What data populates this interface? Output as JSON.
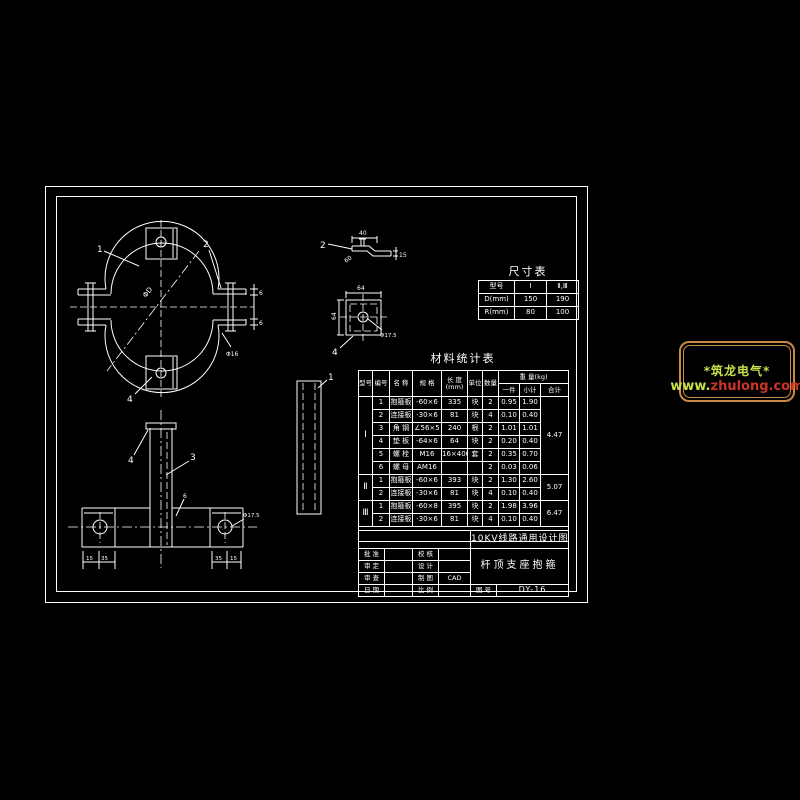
{
  "page": {
    "background": "#000000",
    "line_color": "#ffffff"
  },
  "size_table": {
    "title": "尺寸表",
    "col_headers": [
      "型号",
      "Ⅰ",
      "Ⅱ,Ⅲ"
    ],
    "rows": [
      {
        "label": "D(mm)",
        "v1": "150",
        "v2": "190"
      },
      {
        "label": "R(mm)",
        "v1": "80",
        "v2": "100"
      }
    ]
  },
  "material_table": {
    "title": "材料统计表",
    "headers": {
      "type": "型号",
      "no": "编号",
      "name": "名  称",
      "spec": "规  格",
      "len": "长 度",
      "len_unit": "(mm)",
      "unit": "单位",
      "qty": "数量",
      "weight": "重 量(kg)",
      "per": "一件",
      "sub": "小计",
      "total": "合计"
    },
    "groups": [
      {
        "type": "Ⅰ",
        "total": "4.47",
        "rows": [
          {
            "no": "1",
            "name": "抱箍板",
            "spec": "-60×6",
            "len": "335",
            "unit": "块",
            "qty": "2",
            "per": "0.95",
            "sub": "1.90"
          },
          {
            "no": "2",
            "name": "连接板",
            "spec": "-30×6",
            "len": "81",
            "unit": "块",
            "qty": "4",
            "per": "0.10",
            "sub": "0.40"
          },
          {
            "no": "3",
            "name": "角 钢",
            "spec": "∠56×5",
            "len": "240",
            "unit": "根",
            "qty": "2",
            "per": "1.01",
            "sub": "1.01"
          },
          {
            "no": "4",
            "name": "垫 板",
            "spec": "-64×6",
            "len": "64",
            "unit": "块",
            "qty": "2",
            "per": "0.20",
            "sub": "0.40"
          },
          {
            "no": "5",
            "name": "螺 栓",
            "spec": "M16",
            "len": "16×400",
            "unit": "套",
            "qty": "2",
            "per": "0.35",
            "sub": "0.70"
          },
          {
            "no": "6",
            "name": "螺 母",
            "spec": "AM16",
            "len": "",
            "unit": "",
            "qty": "2",
            "per": "0.03",
            "sub": "0.06"
          }
        ]
      },
      {
        "type": "Ⅱ",
        "total": "5.07",
        "rows": [
          {
            "no": "1",
            "name": "抱箍板",
            "spec": "-60×6",
            "len": "393",
            "unit": "块",
            "qty": "2",
            "per": "1.30",
            "sub": "2.60"
          },
          {
            "no": "2",
            "name": "连接板",
            "spec": "-30×6",
            "len": "81",
            "unit": "块",
            "qty": "4",
            "per": "0.10",
            "sub": "0.40"
          }
        ]
      },
      {
        "type": "Ⅲ",
        "total": "6.47",
        "rows": [
          {
            "no": "1",
            "name": "抱箍板",
            "spec": "-60×8",
            "len": "395",
            "unit": "块",
            "qty": "2",
            "per": "1.98",
            "sub": "3.96"
          },
          {
            "no": "2",
            "name": "连接板",
            "spec": "-30×6",
            "len": "81",
            "unit": "块",
            "qty": "4",
            "per": "0.10",
            "sub": "0.40"
          }
        ]
      }
    ]
  },
  "title_block": {
    "project": "10KV线路通用设计图",
    "drawing_title": "杆顶支座抱箍",
    "rows": [
      {
        "l1": "批 准",
        "v1": "",
        "l2": "校 核",
        "v2": ""
      },
      {
        "l1": "审 定",
        "v1": "",
        "l2": "设 计",
        "v2": ""
      },
      {
        "l1": "审 查",
        "v1": "",
        "l2": "制 图",
        "v2": "CAD"
      },
      {
        "l1": "日 期",
        "v1": "",
        "l2": "比 例",
        "v2": ""
      }
    ],
    "no_label": "图 号",
    "no_value": "DY-16"
  },
  "logo": {
    "line1": "*筑龙电气*",
    "www": "www.",
    "domain": "zhulong.com",
    "border_color": "#c58b46",
    "green": "#c8e04a",
    "red": "#cc3526"
  },
  "fig": {
    "hoop": {
      "l1": "1",
      "l2": "2",
      "l4": "4",
      "dia": "ΦD",
      "bolt": "Φ16",
      "t1": "6",
      "t2": "6"
    },
    "bracket": {
      "l4": "4",
      "l3": "3",
      "l6": "6",
      "hole": "Φ17.5",
      "d1": "15",
      "d2": "35",
      "d3": "35",
      "d4": "15"
    },
    "bent": {
      "l": "2",
      "top": "40",
      "ang": "60",
      "right": "15"
    },
    "pad": {
      "l": "4",
      "top": "64",
      "left": "64",
      "hole": "Φ17.5"
    },
    "strap": {
      "l": "1"
    }
  }
}
